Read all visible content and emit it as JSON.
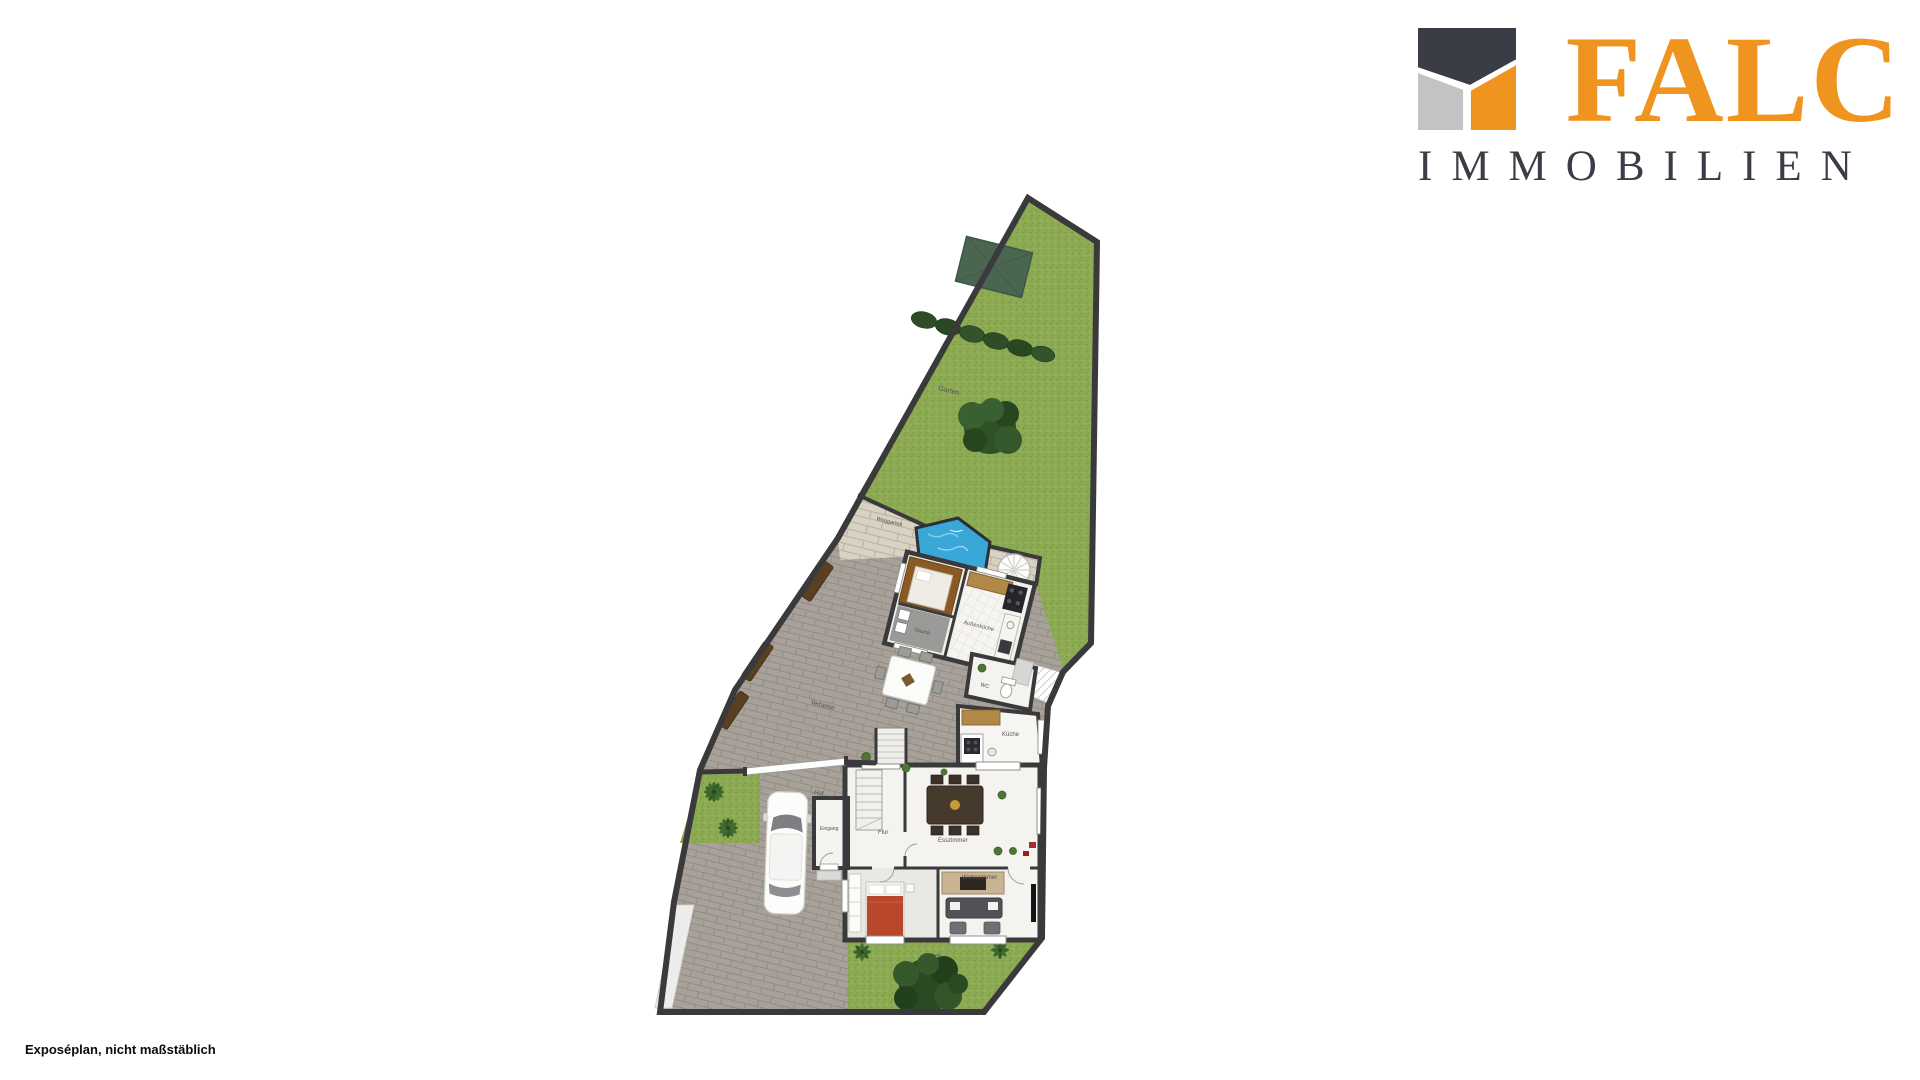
{
  "branding": {
    "company": "FALC",
    "division": "IMMOBILIEN"
  },
  "footnote": "Exposéplan, nicht maßstäblich",
  "plan": {
    "labels": {
      "garden_top": "Garten",
      "garden_path": "Weggarten",
      "terrace": "Terrasse",
      "sauna": "Sauna",
      "outdoor_kitchen": "Außenküche",
      "wc": "WC",
      "kitchen": "Küche",
      "dining_room": "Esszimmer",
      "hallway": "Flur",
      "entrance": "Eingang",
      "living_room": "Wohnzimmer",
      "yard": "Hof",
      "garden_bottom": "Garten"
    },
    "colors": {
      "logo_orange": "#ef941e",
      "logo_dark": "#3a3d45",
      "logo_gray": "#c3c3c5",
      "grass": "#8cab53",
      "hedge": "#2e4d27",
      "pool_water": "#3aa7d9",
      "stone_path": "#d8d2c3",
      "pavers": "#a7a199",
      "walls": "#3a3a3c",
      "sauna_wood": "#8a5a24",
      "bed_red": "#b8472b",
      "tree_green": "#2b4a24"
    }
  }
}
